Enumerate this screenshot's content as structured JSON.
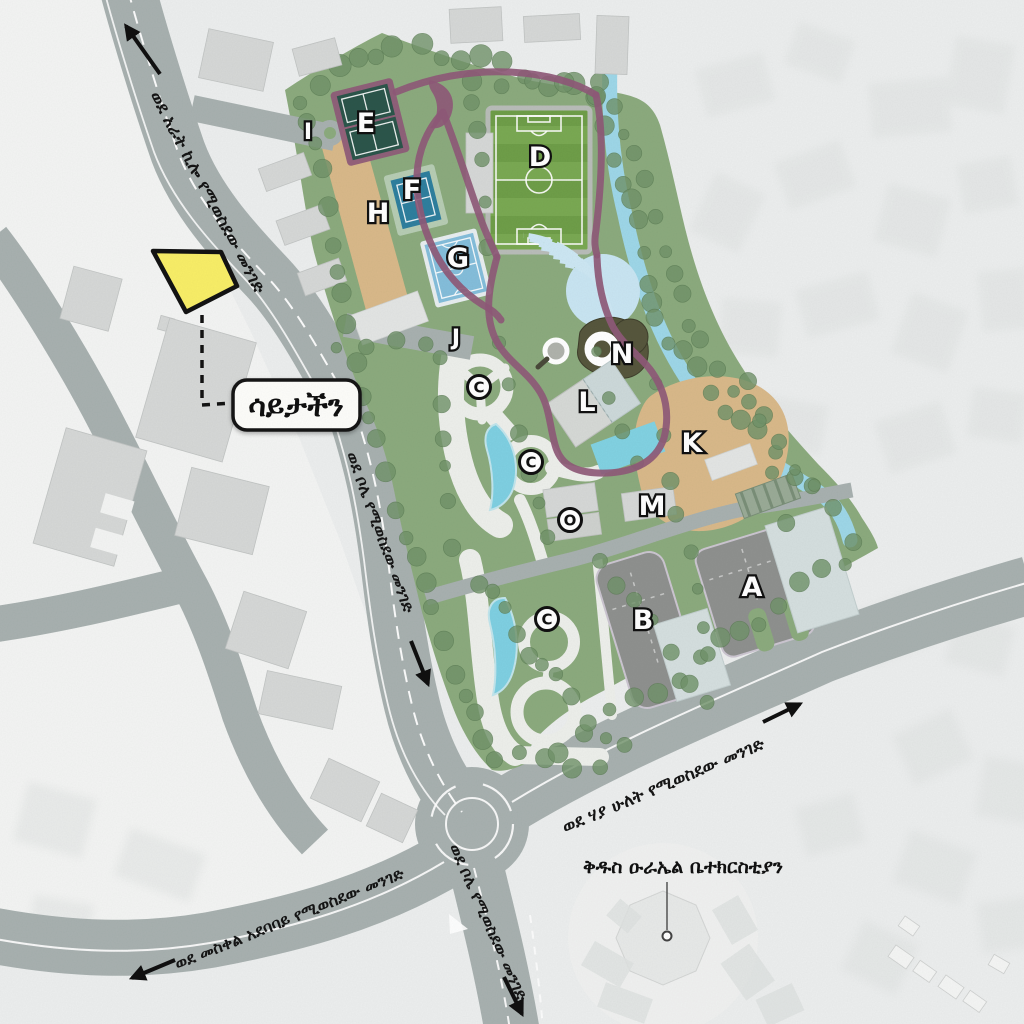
{
  "callout": {
    "site_label": "ሳይታችን"
  },
  "poi": {
    "church": "ቅዱስ ዑራኤል ቤተክርስቲያን"
  },
  "road_labels": {
    "arat_kilo": "ወደ አራት ኪሎ የሚወስደው መንገድ",
    "bole_upper": "ወደ ቦሌ የሚወስደው መንገድ",
    "bole_lower": "ወደ ቦሌ የሚወስደው መንገድ",
    "meskel_square": "ወደ መስቀል አደባባይ የሚወስደው መንገድ",
    "haya_hulet": "ወደ ሃያ ሁለት የሚወስደው መንገድ"
  },
  "markers": {
    "a": "A",
    "b": "B",
    "c": "C",
    "d": "D",
    "e": "E",
    "f": "F",
    "g": "G",
    "h": "H",
    "i": "I",
    "j": "J",
    "k": "K",
    "l": "L",
    "m": "M",
    "n": "N",
    "o": "O"
  },
  "colors": {
    "background": "#eceeee",
    "park_green": "#8cab7e",
    "tree_green": "#71936a",
    "road_gray": "#a8b1b0",
    "river_blue": "#9ed7e8",
    "path_purple": "#8f5a78",
    "sand_tan": "#d9b98a",
    "asphalt_gray": "#8f918f",
    "field_green": "#74a24c",
    "tennis_blue": "#2f7f9e",
    "court_lightblue": "#85bedb",
    "amphitheater_blue": "#c9e5f2",
    "highlight_yellow": "#f8ee68"
  }
}
